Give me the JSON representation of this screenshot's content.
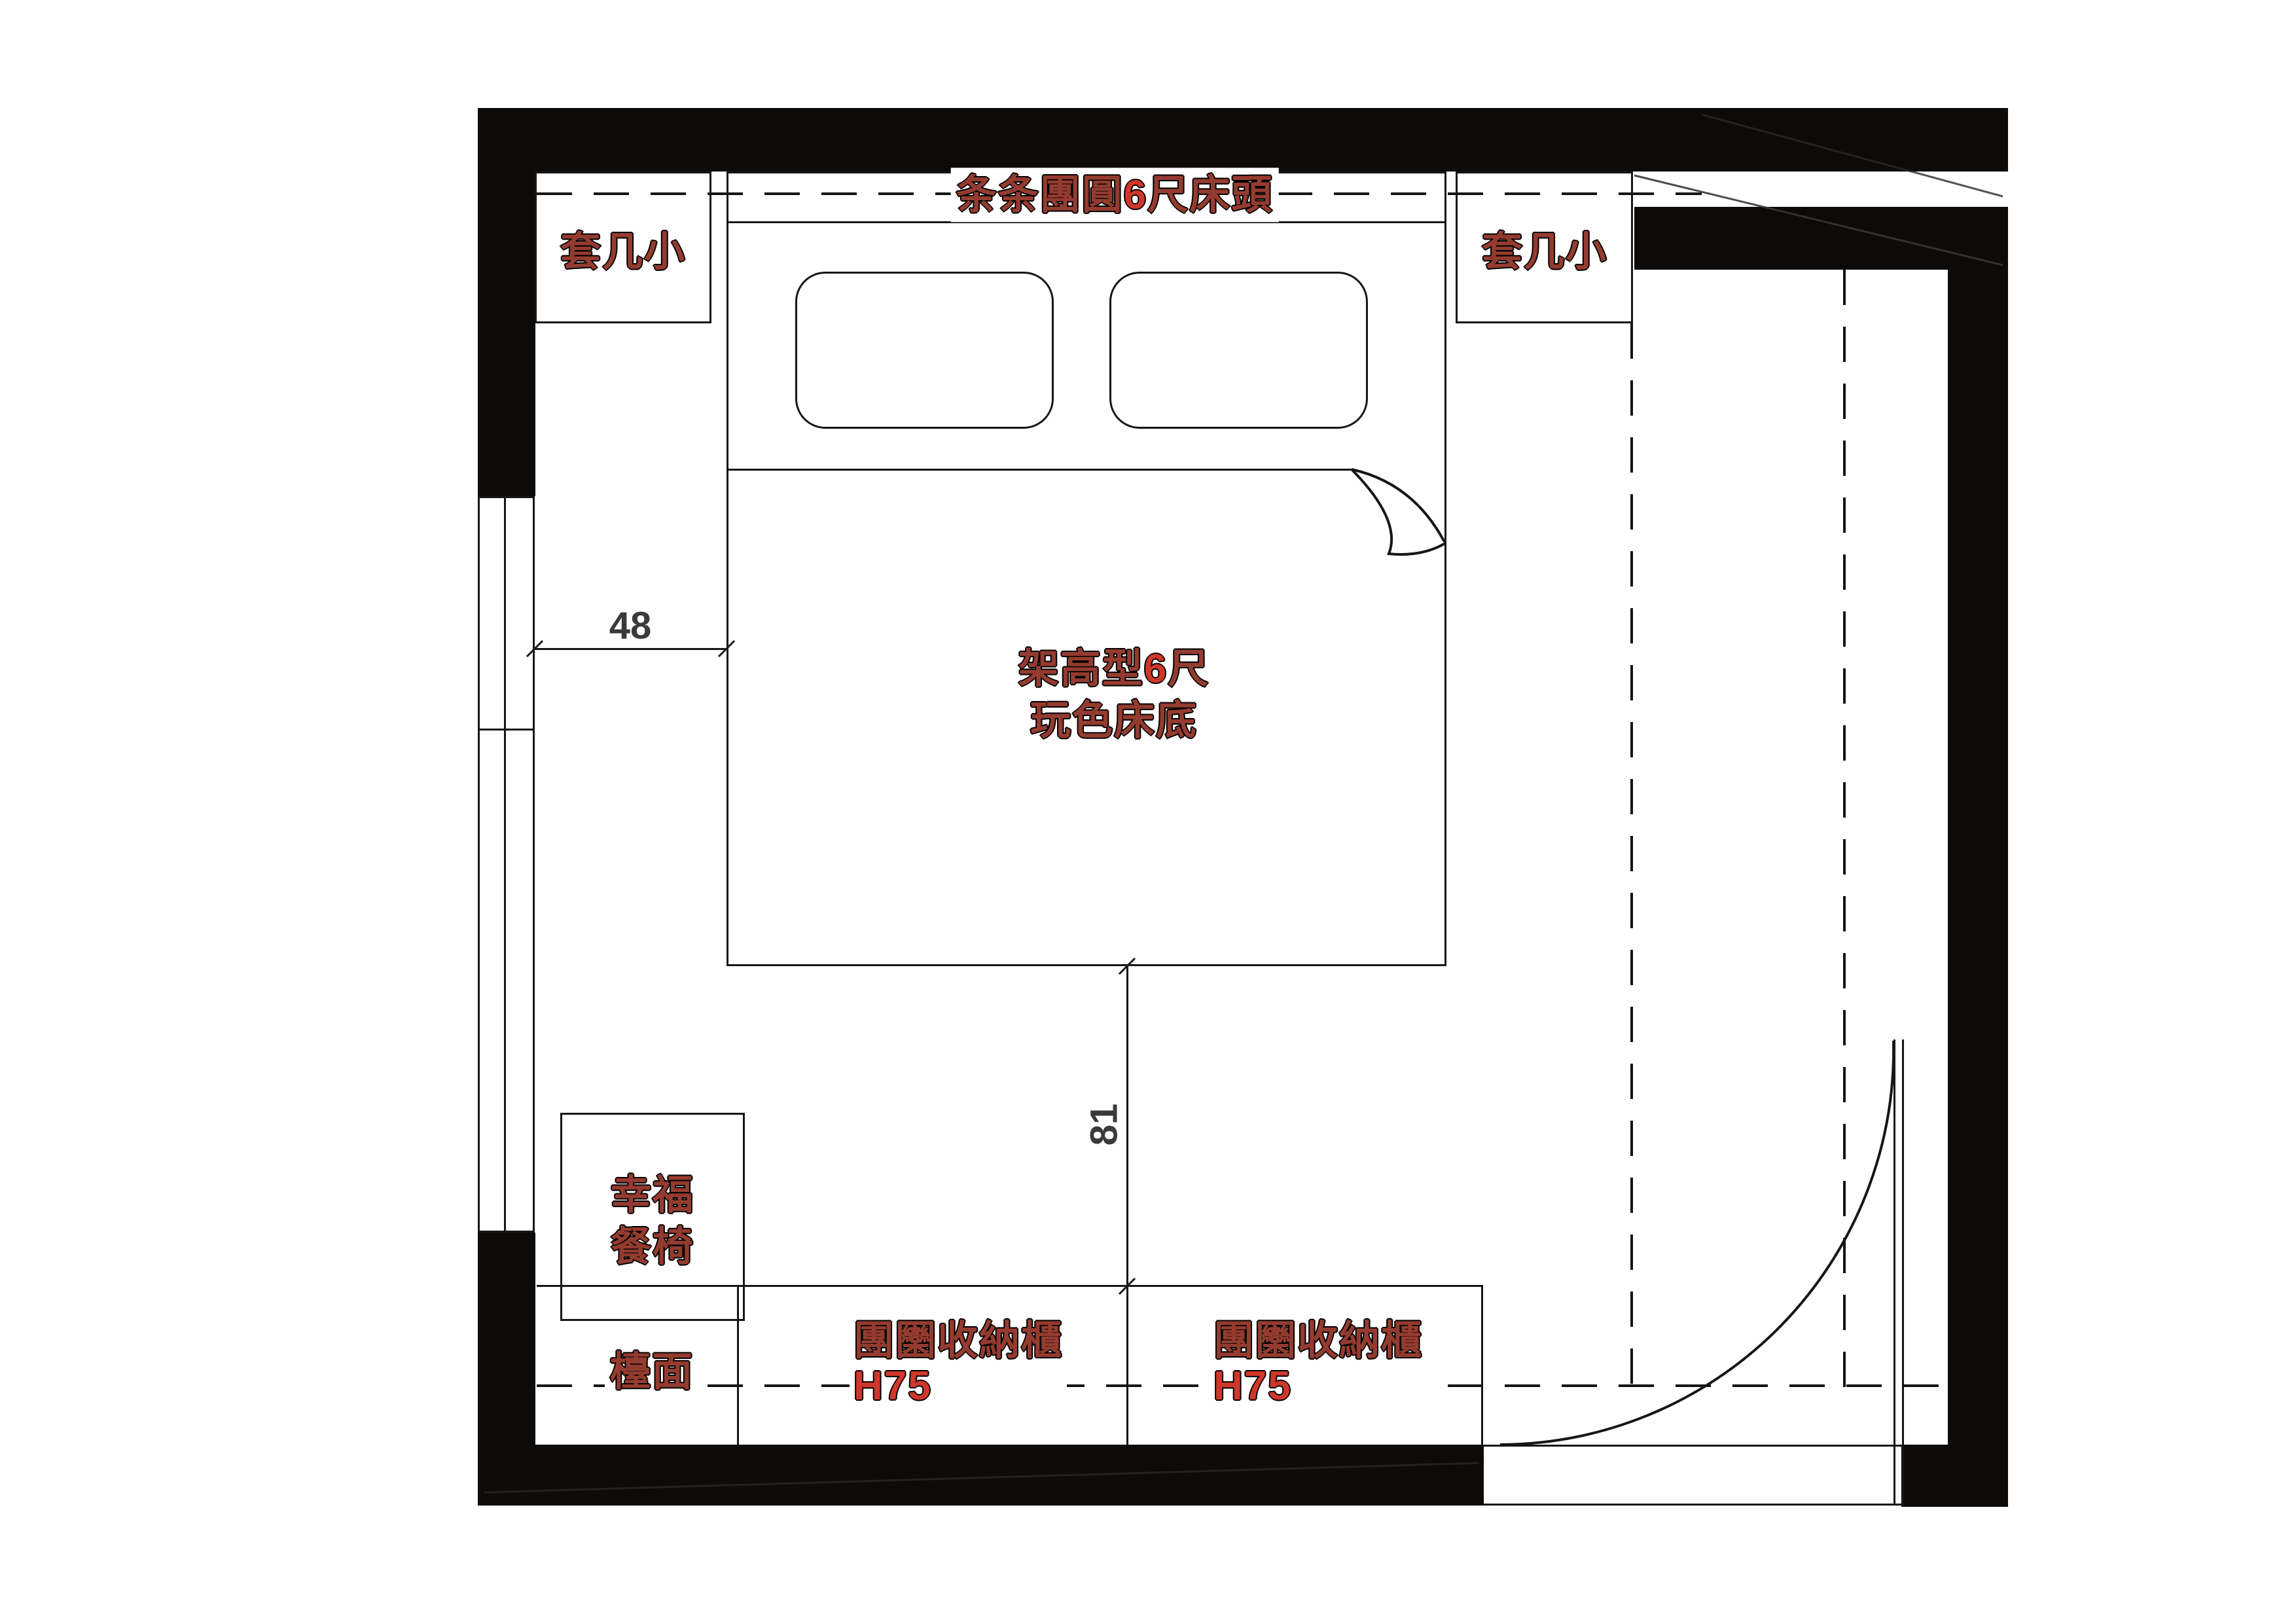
{
  "plan": {
    "title": {
      "prefix": "条条團圓",
      "num": "6",
      "suffix": "尺床頭"
    },
    "side_table_left": {
      "label": "套几小"
    },
    "side_table_right": {
      "label": "套几小"
    },
    "bed": {
      "line1_prefix": "架高型",
      "line1_num": "6",
      "line1_suffix": "尺",
      "line2": "玩色床底"
    },
    "chair": {
      "line1": "幸福",
      "line2": "餐椅"
    },
    "counter": {
      "label": "檯面"
    },
    "cabinet_left": {
      "name": "團圞收納櫃",
      "height": "H75"
    },
    "cabinet_right": {
      "name": "團圞收納櫃",
      "height": "H75"
    },
    "dimensions": {
      "width_48": "48",
      "height_81": "81"
    },
    "colors": {
      "wall_black": "#0c0b0a",
      "label_dark_red": "#943b2f",
      "accent_red": "#cf372a",
      "dimension_gray": "#3a3a3a"
    }
  }
}
